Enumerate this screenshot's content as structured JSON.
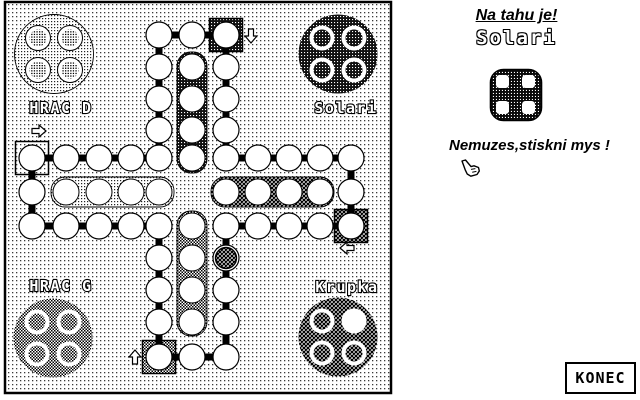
{
  "colors": {
    "ink": "#000000",
    "paper": "#ffffff"
  },
  "board": {
    "players": [
      {
        "id": "hrac-d",
        "label": "HRAC D",
        "corner": "top-left",
        "pattern": "light-dots",
        "start_arrow": "right",
        "home_slots": [
          1,
          1,
          1,
          1
        ]
      },
      {
        "id": "solari",
        "label": "Solari",
        "corner": "top-right",
        "pattern": "dark-dots",
        "start_arrow": "down",
        "home_slots": [
          1,
          1,
          1,
          1
        ]
      },
      {
        "id": "hrac-g",
        "label": "HRAC G",
        "corner": "bottom-left",
        "pattern": "checker",
        "start_arrow": "up",
        "home_slots": [
          1,
          1,
          1,
          1
        ]
      },
      {
        "id": "krupka",
        "label": "Krupka",
        "corner": "bottom-right",
        "pattern": "crosshatch",
        "start_arrow": "left",
        "home_slots": [
          1,
          0,
          1,
          1
        ]
      }
    ],
    "pieces_on_track": [
      {
        "player": "krupka",
        "pattern": "crosshatch",
        "cell": [
          6,
          7
        ]
      }
    ]
  },
  "panel": {
    "turn_heading": "Na tahu je!",
    "turn_player": "Solari",
    "dice_value": 4,
    "message": "Nemuzes,stiskni mys !",
    "hand_icon": "pointing-hand-icon"
  },
  "konec": {
    "label": "KONEC"
  }
}
